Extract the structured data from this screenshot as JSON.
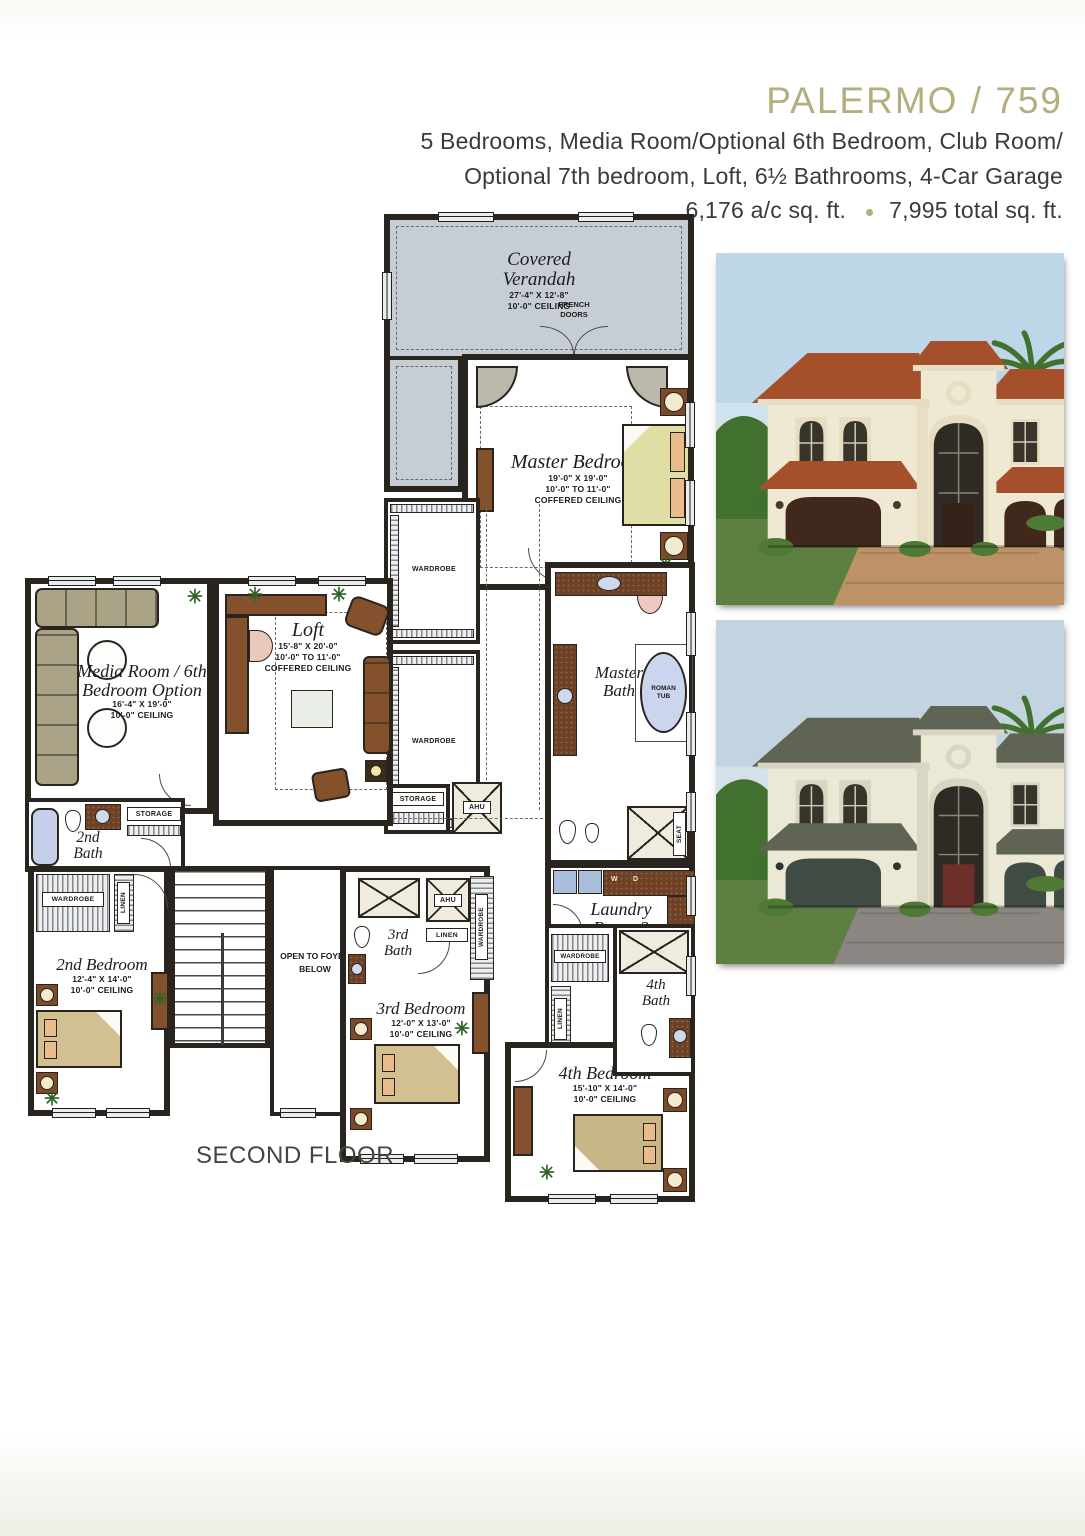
{
  "header": {
    "title": "PALERMO / 759",
    "title_color": "#b4ae7e",
    "specs_line1": "5 Bedrooms, Media Room/Optional 6th Bedroom, Club Room/",
    "specs_line2": "Optional 7th bedroom, Loft, 6½ Bathrooms, 4-Car Garage",
    "sqft_ac": "6,176 a/c sq. ft.",
    "sqft_total": "7,995 total sq. ft."
  },
  "plan": {
    "floor_label": "SECOND FLOOR",
    "wall_color": "#2a241e",
    "verandah_fill": "#c6cdd5",
    "rooms": {
      "verandah": {
        "name_line1": "Covered",
        "name_line2": "Verandah",
        "dims": "27'-4\" X 12'-8\"",
        "ceiling": "10'-0\" CEILING"
      },
      "master_bedroom": {
        "name": "Master Bedroom",
        "dims": "19'-0\" X 19'-0\"",
        "ceiling": "10'-0\" TO 11'-0\"",
        "ceiling2": "COFFERED CEILING"
      },
      "media_room": {
        "name_line1": "Media Room / 6th",
        "name_line2": "Bedroom Option",
        "dims": "16'-4\" X 19'-0\"",
        "ceiling": "10'-0\" CEILING"
      },
      "loft": {
        "name": "Loft",
        "dims": "15'-8\" X 20'-0\"",
        "ceiling": "10'-0\" TO 11'-0\"",
        "ceiling2": "COFFERED CEILING"
      },
      "master_bath": {
        "name_line1": "Master",
        "name_line2": "Bath",
        "tub_line1": "ROMAN",
        "tub_line2": "TUB"
      },
      "bath2": {
        "name_line1": "2nd",
        "name_line2": "Bath"
      },
      "bedroom2": {
        "name": "2nd Bedroom",
        "dims": "12'-4\" X 14'-0\"",
        "ceiling": "10'-0\" CEILING"
      },
      "bath3": {
        "name_line1": "3rd",
        "name_line2": "Bath"
      },
      "bedroom3": {
        "name": "3rd Bedroom",
        "dims": "12'-0\" X 13'-0\"",
        "ceiling": "10'-0\" CEILING"
      },
      "laundry": {
        "name_line1": "Laundry",
        "name_line2": "Room 2"
      },
      "bath4": {
        "name_line1": "4th",
        "name_line2": "Bath"
      },
      "bedroom4": {
        "name": "4th Bedroom",
        "dims": "15'-10\" X 14'-0\"",
        "ceiling": "10'-0\" CEILING"
      },
      "foyer": {
        "line1": "OPEN TO FOYER",
        "line2": "BELOW"
      }
    },
    "labels": {
      "french_doors_line1": "FRENCH",
      "french_doors_line2": "DOORS",
      "wardrobe": "WARDROBE",
      "linen": "LINEN",
      "storage": "STORAGE",
      "ahu": "AHU",
      "seat": "SEAT",
      "washer": "W",
      "dryer": "D",
      "plant_glyph": "✳"
    }
  },
  "renderings": [
    {
      "sky": "#bdd6e8",
      "roof": "#a6502b",
      "wall": "#efe8d2",
      "trim": "#e6ddc2",
      "garage": "#40291c",
      "door": "#352218",
      "driveway": "#bd9266",
      "lawn": "#5d8042",
      "palm": "#41702f"
    },
    {
      "sky": "#c2d4e0",
      "roof": "#5f6455",
      "wall": "#ebe8d6",
      "trim": "#d9d5c3",
      "garage": "#3f4b43",
      "door": "#6e2f28",
      "driveway": "#8b8681",
      "lawn": "#5d8042",
      "palm": "#41702f"
    }
  ]
}
